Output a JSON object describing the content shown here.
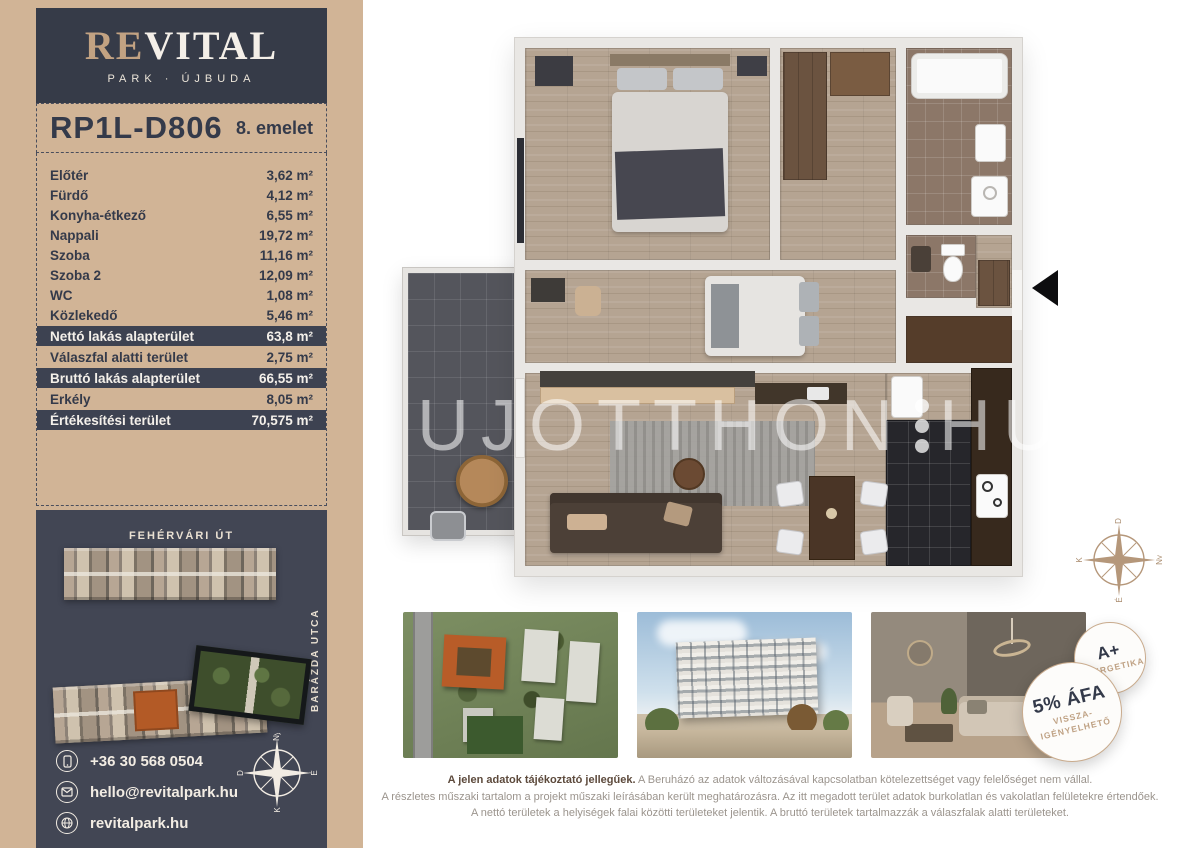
{
  "colors": {
    "tan_panel": "#d1b496",
    "navy": "#363b48",
    "row_highlight": "#3d4251",
    "dark_panel": "#424654",
    "brand_tan": "#c2a282",
    "orange_highlight": "#b35a26",
    "badge_border": "#c9ab8d",
    "disclaimer_bold": "#5d4a3c"
  },
  "sidebar": {
    "logo": {
      "brand_re": "RE",
      "brand_vital": "VITAL",
      "subtitle": "PARK · ÚJBUDA"
    },
    "unit": {
      "code": "RP1L-D806",
      "floor": "8. emelet"
    },
    "rooms": [
      {
        "label": "Előtér",
        "value": "3,62 m²",
        "highlight": false
      },
      {
        "label": "Fürdő",
        "value": "4,12 m²",
        "highlight": false
      },
      {
        "label": "Konyha-étkező",
        "value": "6,55 m²",
        "highlight": false
      },
      {
        "label": "Nappali",
        "value": "19,72 m²",
        "highlight": false
      },
      {
        "label": "Szoba",
        "value": "11,16 m²",
        "highlight": false
      },
      {
        "label": "Szoba 2",
        "value": "12,09 m²",
        "highlight": false
      },
      {
        "label": "WC",
        "value": "1,08 m²",
        "highlight": false
      },
      {
        "label": "Közlekedő",
        "value": "5,46 m²",
        "highlight": false
      },
      {
        "label": "Nettó lakás alapterület",
        "value": "63,8 m²",
        "highlight": true
      },
      {
        "label": "Válaszfal alatti terület",
        "value": "2,75 m²",
        "highlight": false
      },
      {
        "label": "Bruttó lakás alapterület",
        "value": "66,55 m²",
        "highlight": true
      },
      {
        "label": "Erkély",
        "value": "8,05 m²",
        "highlight": false
      },
      {
        "label": "Értékesítési terület",
        "value": "70,575 m²",
        "highlight": true
      }
    ],
    "siteplan": {
      "street_top": "FEHÉRVÁRI ÚT",
      "street_right": "BARÁZDA UTCA"
    },
    "contact": [
      {
        "icon": "phone-icon",
        "text": "+36 30 568 0504"
      },
      {
        "icon": "mail-icon",
        "text": "hello@revitalpark.hu"
      },
      {
        "icon": "globe-icon",
        "text": "revitalpark.hu"
      }
    ],
    "compass_white": {
      "top": "Ny",
      "right": "É",
      "bottom": "K",
      "left": "D"
    }
  },
  "floorplan": {
    "watermark": {
      "part1": "UJOTTHON",
      "part2": "HU"
    }
  },
  "compass_tan": {
    "top": "D",
    "right": "Ny",
    "bottom": "É",
    "left": "K"
  },
  "badges": {
    "energy": {
      "line1": "A+",
      "line2": "ENERGETIKA"
    },
    "vat": {
      "line1": "5% ÁFA",
      "line2": "VISSZA-",
      "line3": "IGÉNYELHETŐ"
    }
  },
  "disclaimer": {
    "intro_bold": "A jelen adatok tájékoztató jellegűek.",
    "intro_rest": "A Beruházó az adatok változásával kapcsolatban kötelezettséget vagy felelőséget nem vállal.",
    "line2": "A részletes műszaki tartalom a projekt műszaki leírásában került meghatározásra. Az itt megadott terület adatok burkolatlan és vakolatlan felületekre értendőek.",
    "line3": "A nettó területek a helyiségek falai közötti területeket jelentik. A bruttó területek tartalmazzák a válaszfalak alatti területeket."
  }
}
